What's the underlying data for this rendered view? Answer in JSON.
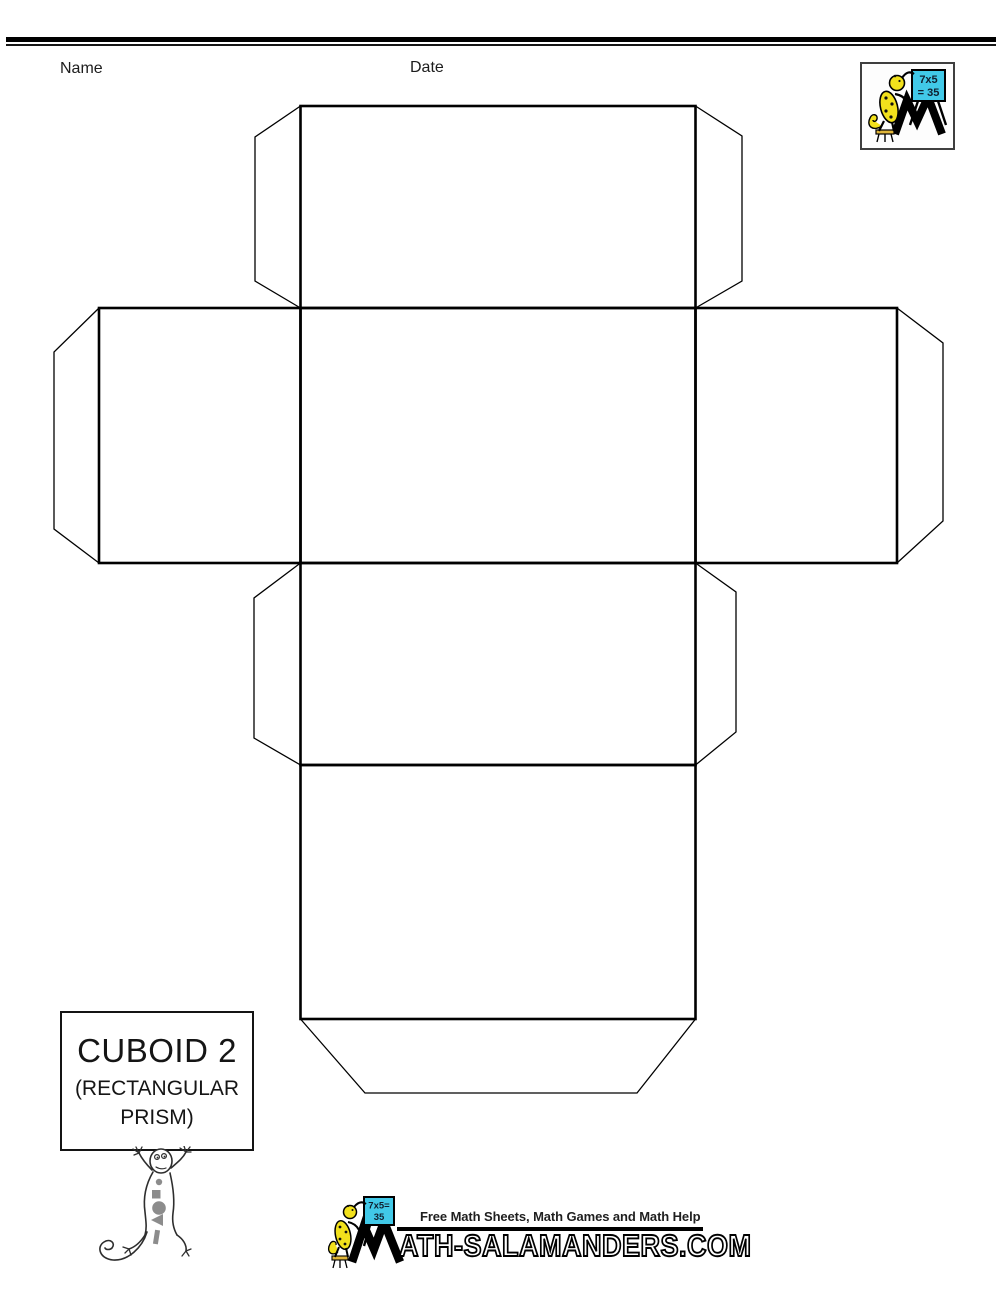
{
  "header": {
    "name_label": "Name",
    "date_label": "Date"
  },
  "corner_logo": {
    "board_line1": "7x5",
    "board_line2": "= 35"
  },
  "title_box": {
    "title": "CUBOID 2",
    "subtitle_line1": "(RECTANGULAR",
    "subtitle_line2": "PRISM)"
  },
  "footer": {
    "tagline": "Free Math Sheets, Math Games and Math Help",
    "board_line1": "7x5=",
    "board_line2": "35",
    "wordmark": "ATH-SALAMANDERS.COM"
  },
  "colors": {
    "ink": "#000000",
    "salamander_yellow": "#f2e11c",
    "board_cyan": "#41c9e8",
    "belly_shape_gray": "#8c8c8c"
  }
}
